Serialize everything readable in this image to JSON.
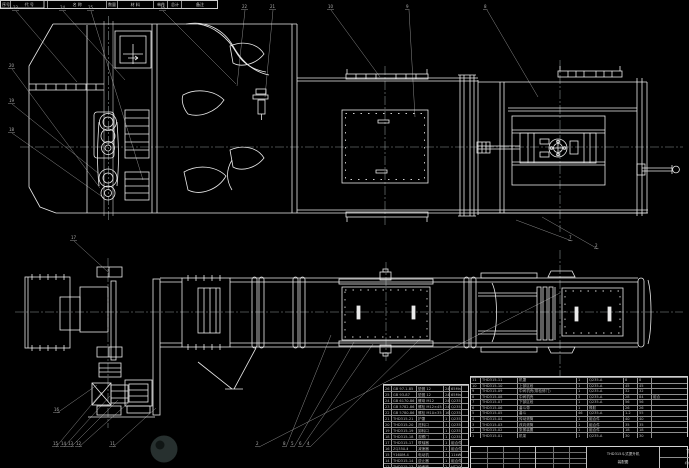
{
  "title_block": {
    "drawing_title_line1": "THD315斗式提升机",
    "drawing_title_line2": "装配图",
    "drawing_number": "THD315-00",
    "organization": "机械设计制造及自动化"
  },
  "bom_right": {
    "headers": [
      "序号",
      "代 号",
      "名 称",
      "数量",
      "材 料",
      "单件",
      "总计",
      "备注"
    ],
    "rows": [
      [
        "11",
        "THD315-11",
        "机罩",
        "1",
        "Q235-A",
        "8",
        "8",
        ""
      ],
      [
        "10",
        "THD315-10",
        "上部区段",
        "1",
        "Q235-A",
        "45",
        "45",
        ""
      ],
      [
        "9",
        "THD315-09",
        "中间机壳(带检修门)",
        "1",
        "Q235-A",
        "32",
        "32",
        ""
      ],
      [
        "8",
        "THD315-08",
        "中间机壳",
        "3",
        "Q235-A",
        "28",
        "84",
        "组合"
      ],
      [
        "7",
        "THD315-07",
        "下部区段",
        "1",
        "Q235-A",
        "56",
        "56",
        ""
      ],
      [
        "6",
        "THD315-06",
        "畚斗带",
        "1",
        "橡胶",
        "26",
        "26",
        ""
      ],
      [
        "5",
        "THD315-05",
        "畚斗",
        "46",
        "Q235-A",
        "1.2",
        "55",
        ""
      ],
      [
        "4",
        "THD315-04",
        "传动滚筒",
        "1",
        "组合件",
        "40",
        "40",
        ""
      ],
      [
        "3",
        "THD315-03",
        "改向滚筒",
        "1",
        "组合件",
        "35",
        "35",
        ""
      ],
      [
        "2",
        "THD315-02",
        "张紧装置",
        "1",
        "组合件",
        "18",
        "18",
        ""
      ],
      [
        "1",
        "THD315-01",
        "机架",
        "1",
        "Q235-A",
        "30",
        "30",
        ""
      ]
    ]
  },
  "bom_left": {
    "rows": [
      [
        "26",
        "GB 97.1-85",
        "垫圈 12",
        "24",
        "65Mn",
        ""
      ],
      [
        "25",
        "GB 93-87",
        "垫圈 12",
        "24",
        "65Mn",
        ""
      ],
      [
        "24",
        "GB 6170-86",
        "螺母 M12",
        "24",
        "Q235-A",
        ""
      ],
      [
        "23",
        "GB 5782-86",
        "螺栓 M12×45",
        "24",
        "Q235-A",
        ""
      ],
      [
        "22",
        "GB 5780-86",
        "螺栓 M10×35",
        "16",
        "Q235-A",
        ""
      ],
      [
        "21",
        "THD315-21",
        "护罩",
        "1",
        "Q235-A",
        ""
      ],
      [
        "20",
        "THD315-20",
        "进料口",
        "1",
        "Q235-A",
        ""
      ],
      [
        "19",
        "THD315-19",
        "卸料口",
        "1",
        "Q235-A",
        ""
      ],
      [
        "18",
        "THD315-18",
        "观察门",
        "1",
        "Q235-A",
        ""
      ],
      [
        "17",
        "THD315-17",
        "联轴器",
        "1",
        "组合件",
        ""
      ],
      [
        "16",
        "ZQ350-Ⅱ",
        "减速器",
        "1",
        "组合件",
        ""
      ],
      [
        "15",
        "Y160M-4",
        "电动机",
        "1",
        "11kW",
        ""
      ],
      [
        "14",
        "THD315-14",
        "逆止器",
        "1",
        "组合件",
        ""
      ],
      [
        "13",
        "THD315-13",
        "轴承座",
        "2",
        "HT200",
        ""
      ]
    ]
  },
  "callouts": [
    {
      "x": 12,
      "y": 6,
      "label": "23"
    },
    {
      "x": 59,
      "y": 6,
      "label": "24"
    },
    {
      "x": 87,
      "y": 6,
      "label": "25"
    },
    {
      "x": 159,
      "y": 6,
      "label": "26"
    },
    {
      "x": 241,
      "y": 5,
      "label": "22"
    },
    {
      "x": 269,
      "y": 5,
      "label": "21"
    },
    {
      "x": 327,
      "y": 5,
      "label": "10"
    },
    {
      "x": 405,
      "y": 5,
      "label": "9"
    },
    {
      "x": 483,
      "y": 5,
      "label": "8"
    },
    {
      "x": 8,
      "y": 64,
      "label": "20"
    },
    {
      "x": 8,
      "y": 99,
      "label": "19"
    },
    {
      "x": 8,
      "y": 128,
      "label": "18"
    },
    {
      "x": 568,
      "y": 236,
      "label": "7"
    },
    {
      "x": 594,
      "y": 244,
      "label": "2"
    },
    {
      "x": 70,
      "y": 236,
      "label": "17"
    },
    {
      "x": 53,
      "y": 408,
      "label": "16"
    },
    {
      "x": 52,
      "y": 442,
      "label": "15"
    },
    {
      "x": 60,
      "y": 442,
      "label": "14"
    },
    {
      "x": 67,
      "y": 442,
      "label": "13"
    },
    {
      "x": 75,
      "y": 442,
      "label": "12"
    },
    {
      "x": 109,
      "y": 442,
      "label": "11"
    },
    {
      "x": 255,
      "y": 442,
      "label": "2"
    },
    {
      "x": 282,
      "y": 442,
      "label": "8"
    },
    {
      "x": 290,
      "y": 442,
      "label": "5"
    },
    {
      "x": 298,
      "y": 442,
      "label": "6"
    },
    {
      "x": 306,
      "y": 442,
      "label": "4"
    }
  ]
}
